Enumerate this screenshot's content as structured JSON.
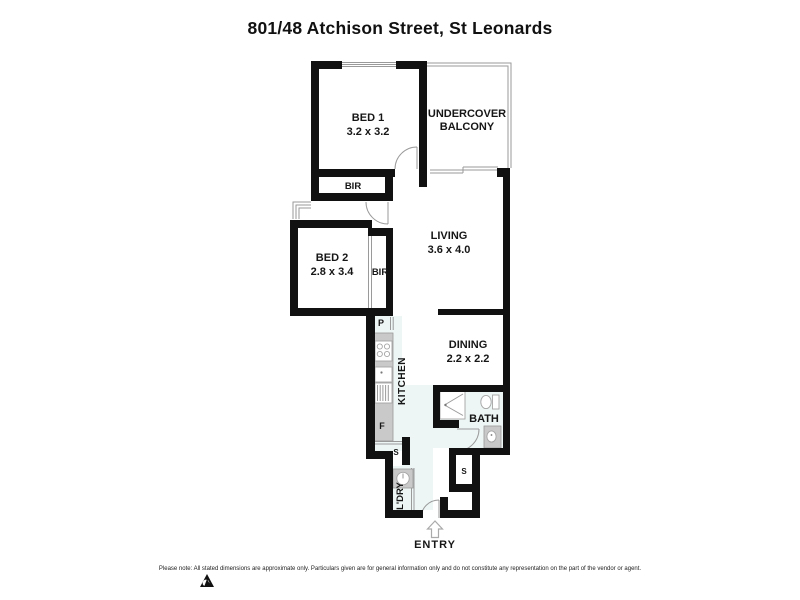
{
  "page": {
    "title": "801/48 Atchison Street, St Leonards",
    "footer_disclaimer": "Please note: All stated dimensions are approximate only. Particulars given are for general information only and do not constitute any representation on the part of the vendor or agent."
  },
  "floorplan": {
    "rooms": {
      "bed1": {
        "name": "BED 1",
        "dimensions": "3.2 x 3.2"
      },
      "balcony": {
        "name_line1": "UNDERCOVER",
        "name_line2": "BALCONY"
      },
      "bed2": {
        "name": "BED 2",
        "dimensions": "2.8 x 3.4"
      },
      "living": {
        "name": "LIVING",
        "dimensions": "3.6 x 4.0"
      },
      "dining": {
        "name": "DINING",
        "dimensions": "2.2 x 2.2"
      },
      "kitchen": {
        "name": "KITCHEN"
      },
      "bath": {
        "name": "BATH"
      },
      "laundry": {
        "name": "L'DRY"
      },
      "entry": {
        "name": "ENTRY"
      }
    },
    "storage": {
      "bir_bed1": "BIR",
      "bir_bed2": "BIR",
      "pantry": "P",
      "fridge": "F",
      "store_kitchen": "S",
      "store_hall": "S"
    },
    "colors": {
      "wall": "#111111",
      "thin_line": "#9a9a9a",
      "fixture_fill": "#c9c9c9",
      "floor_tint": "#edf6f5"
    }
  }
}
